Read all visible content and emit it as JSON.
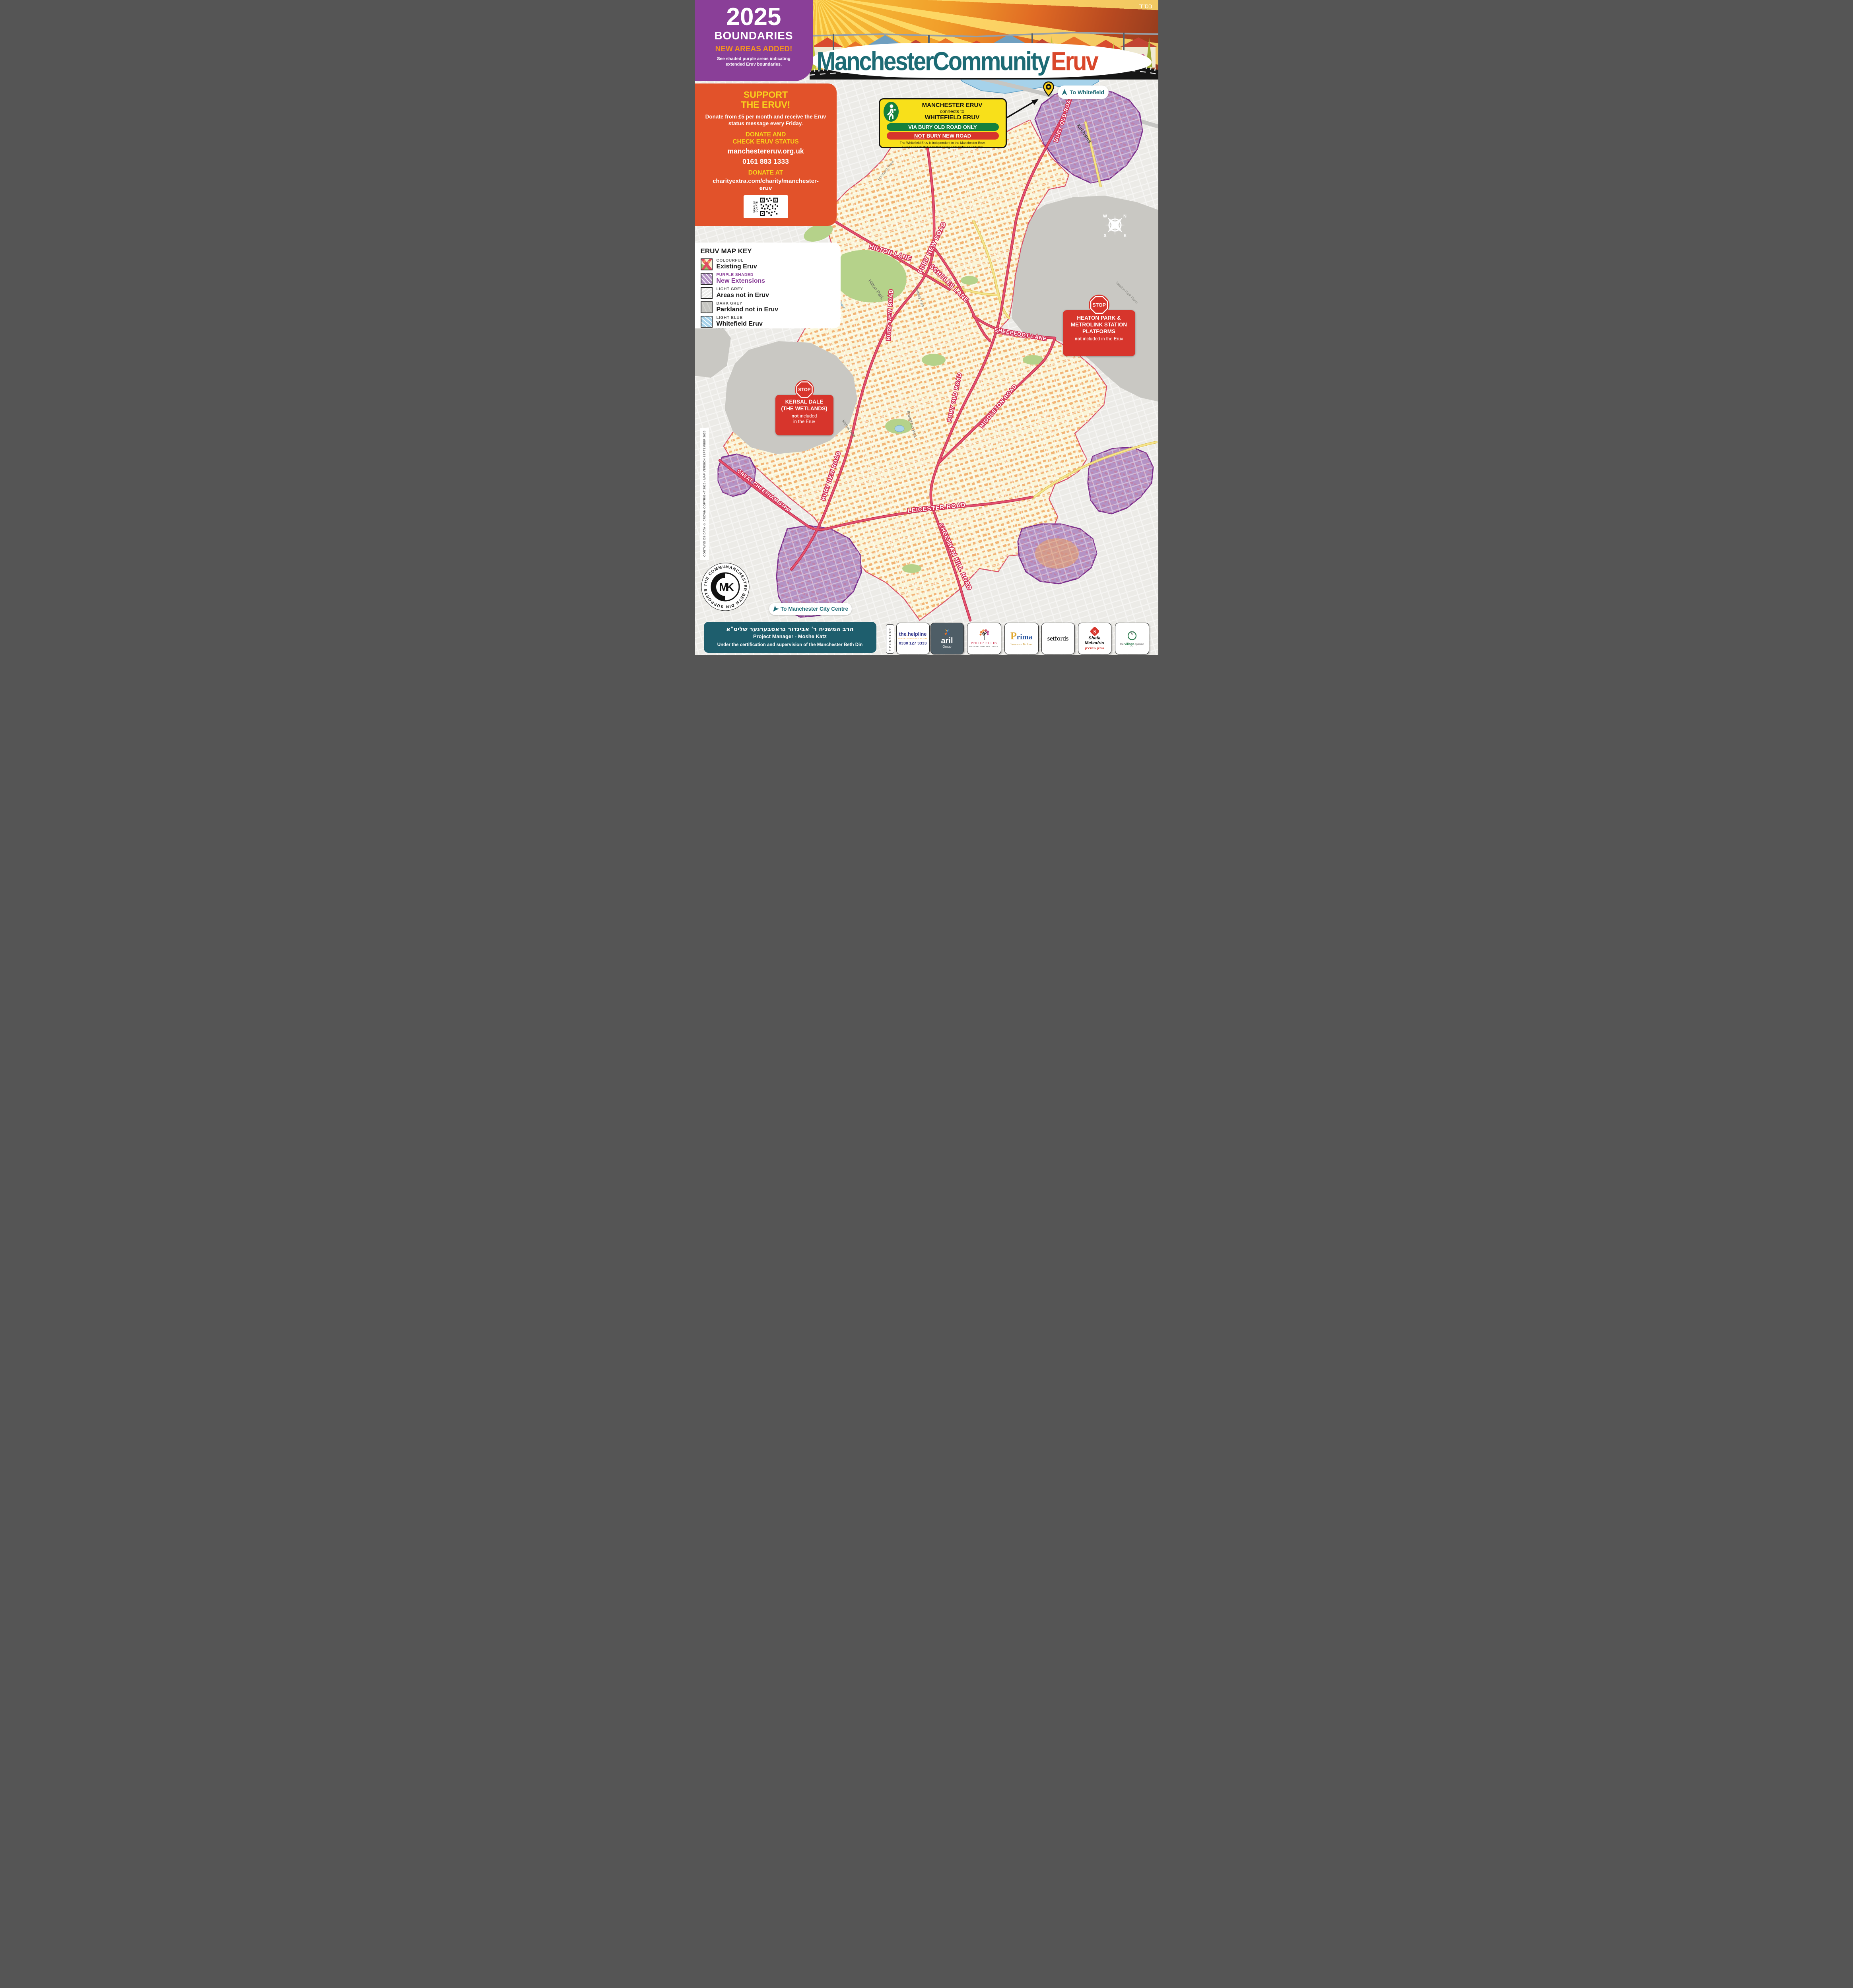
{
  "meta": {
    "bsd": "בס\"ד"
  },
  "header": {
    "title_part1": "Manchester",
    "title_part2": "Community",
    "title_part3": "Eruv",
    "boundaries_box": {
      "year": "2025",
      "title": "BOUNDARIES",
      "subtitle": "NEW AREAS ADDED!",
      "description_line1": "See shaded purple areas indicating",
      "description_line2": "extended Eruv boundaries."
    }
  },
  "support_box": {
    "title_line1": "SUPPORT",
    "title_line2": "THE ERUV!",
    "body": "Donate from £5 per month and receive the Eruv status message every Friday.",
    "donate_heading_line1": "DONATE AND",
    "donate_heading_line2": "CHECK ERUV STATUS",
    "website": "manchestereruv.org.uk",
    "phone": "0161 883 1333",
    "donate_at": "DONATE AT",
    "donate_url": "charityextra.com/charity/manchester-eruv",
    "qr_label": "SCAN TO DONATE"
  },
  "map_key": {
    "title": "ERUV MAP KEY",
    "items": [
      {
        "label_top": "COLOURFUL",
        "label": "Existing Eruv"
      },
      {
        "label_top": "PURPLE SHADED",
        "label": "New Extensions"
      },
      {
        "label_top": "LIGHT GREY",
        "label": "Areas not in Eruv"
      },
      {
        "label_top": "DARK GREY",
        "label": "Parkland not in Eruv"
      },
      {
        "label_top": "LIGHT BLUE",
        "label": "Whitefield Eruv"
      }
    ]
  },
  "connector_box": {
    "line1": "MANCHESTER ERUV",
    "line2": "connects to",
    "line3": "WHITEFIELD ERUV",
    "green_pill": "VIA BURY OLD ROAD ONLY",
    "red_pill_not": "NOT",
    "red_pill_rest": " BURY NEW ROAD",
    "footnote1": "The Whitefield Eruv is independent to the Manchester Eruv.",
    "footnote2": "Please check status before using at ",
    "footnote2_bold": "thewhc.co.uk/eruv"
  },
  "to_whitefield": "To Whitefield",
  "to_city_centre": "To Manchester City Centre",
  "stop_boxes": {
    "stop": "STOP",
    "heaton": {
      "line1": "HEATON PARK &",
      "line2": "METROLINK STATION",
      "line3": "PLATFORMS",
      "not": "not",
      "rest": " included in the Eruv"
    },
    "kersal": {
      "line1": "KERSAL DALE",
      "line2": "(THE WETLANDS)",
      "not": "not",
      "rest1": " included",
      "rest2": "in the Eruv"
    }
  },
  "map": {
    "road_labels": [
      {
        "text": "BURY OLD ROAD"
      },
      {
        "text": "HILTON LANE"
      },
      {
        "text": "BURY NEW ROAD"
      },
      {
        "text": "SCHOLES LANE"
      },
      {
        "text": "BURY NEW ROAD"
      },
      {
        "text": "SHEEPFOOT LANE"
      },
      {
        "text": "BURY OLD ROAD"
      },
      {
        "text": "MIDDLETON ROAD"
      },
      {
        "text": "BURY NEW ROAD"
      },
      {
        "text": "LEICESTER ROAD"
      },
      {
        "text": "GREAT CHEETHAM ST W"
      },
      {
        "text": "CHEETHAM HILL ROAD"
      }
    ],
    "area_labels": [
      {
        "text": "Kirkhams"
      },
      {
        "text": "Heaton Park Farm"
      },
      {
        "text": "Hilton Park"
      },
      {
        "text": "Sedgley Park"
      },
      {
        "text": "Kersal"
      },
      {
        "text": "Singleton Brook"
      },
      {
        "text": "Lower Kersal"
      },
      {
        "text": "Kersal Dale"
      },
      {
        "text": "Broughton Park"
      },
      {
        "text": "Prestwich Bank"
      },
      {
        "text": "M60"
      }
    ],
    "compass": {
      "n": "N",
      "e": "E",
      "s": "S",
      "w": "W"
    }
  },
  "footer": {
    "hebrew": "הרב המשגיח ר' אביגדור גראסבערגער שליט\"א",
    "project_manager": "Project Manager - Moshe Katz",
    "certification": "Under the certification and supervision of the Manchester Beth Din",
    "sponsors_label": "SPONSORS",
    "sponsors": [
      {
        "part1": "the",
        "dot": ".",
        "part2": "helpline",
        "tagline": "NEVER STRUGGLE ALONE",
        "phone": "0330 127 3333"
      },
      {
        "name": "aril",
        "sub": "Group"
      },
      {
        "name": "PHILIP ELLIS",
        "sub": "ESTATE AND LETTINGS"
      },
      {
        "p": "P",
        "rest": "rima",
        "sub": "Insurance Brokers"
      },
      {
        "name": "setfords"
      },
      {
        "line1": "Shefa",
        "line2": "Mehadrin",
        "hebrew": "שפע מהדרין",
        "initial": "S"
      },
      {
        "pre": "the ",
        "highlight": "Village",
        "post": " optician",
        "suffix": "Ltd",
        "initial": "V"
      }
    ],
    "copyright": "CONTAINS OS DATA © CROWN COPYRIGHT 2025 / MAP VERSION SEPTEMBER 2025",
    "beth_din_ring": "MANCHESTER BETH DIN SUPPORTS THE COMMUNITY • SUPPORTS •",
    "beth_din_monogram": "MK"
  },
  "colors": {
    "purple_box": "#8a3f98",
    "orange_box": "#e2522a",
    "yellow_box": "#f8e01a",
    "teal": "#1d6b75",
    "stop_red": "#d7352c",
    "eruv_cream": "#faf5d8",
    "extension_purple": "#b493c5",
    "extension_border": "#7b2e8c",
    "not_in_eruv_grey": "#ecebe7",
    "parkland_grey": "#c9c8c3",
    "whitefield_blue": "#a6d2ea",
    "main_road_red": "#e5506d",
    "secondary_road_yellow": "#f6e48a"
  }
}
